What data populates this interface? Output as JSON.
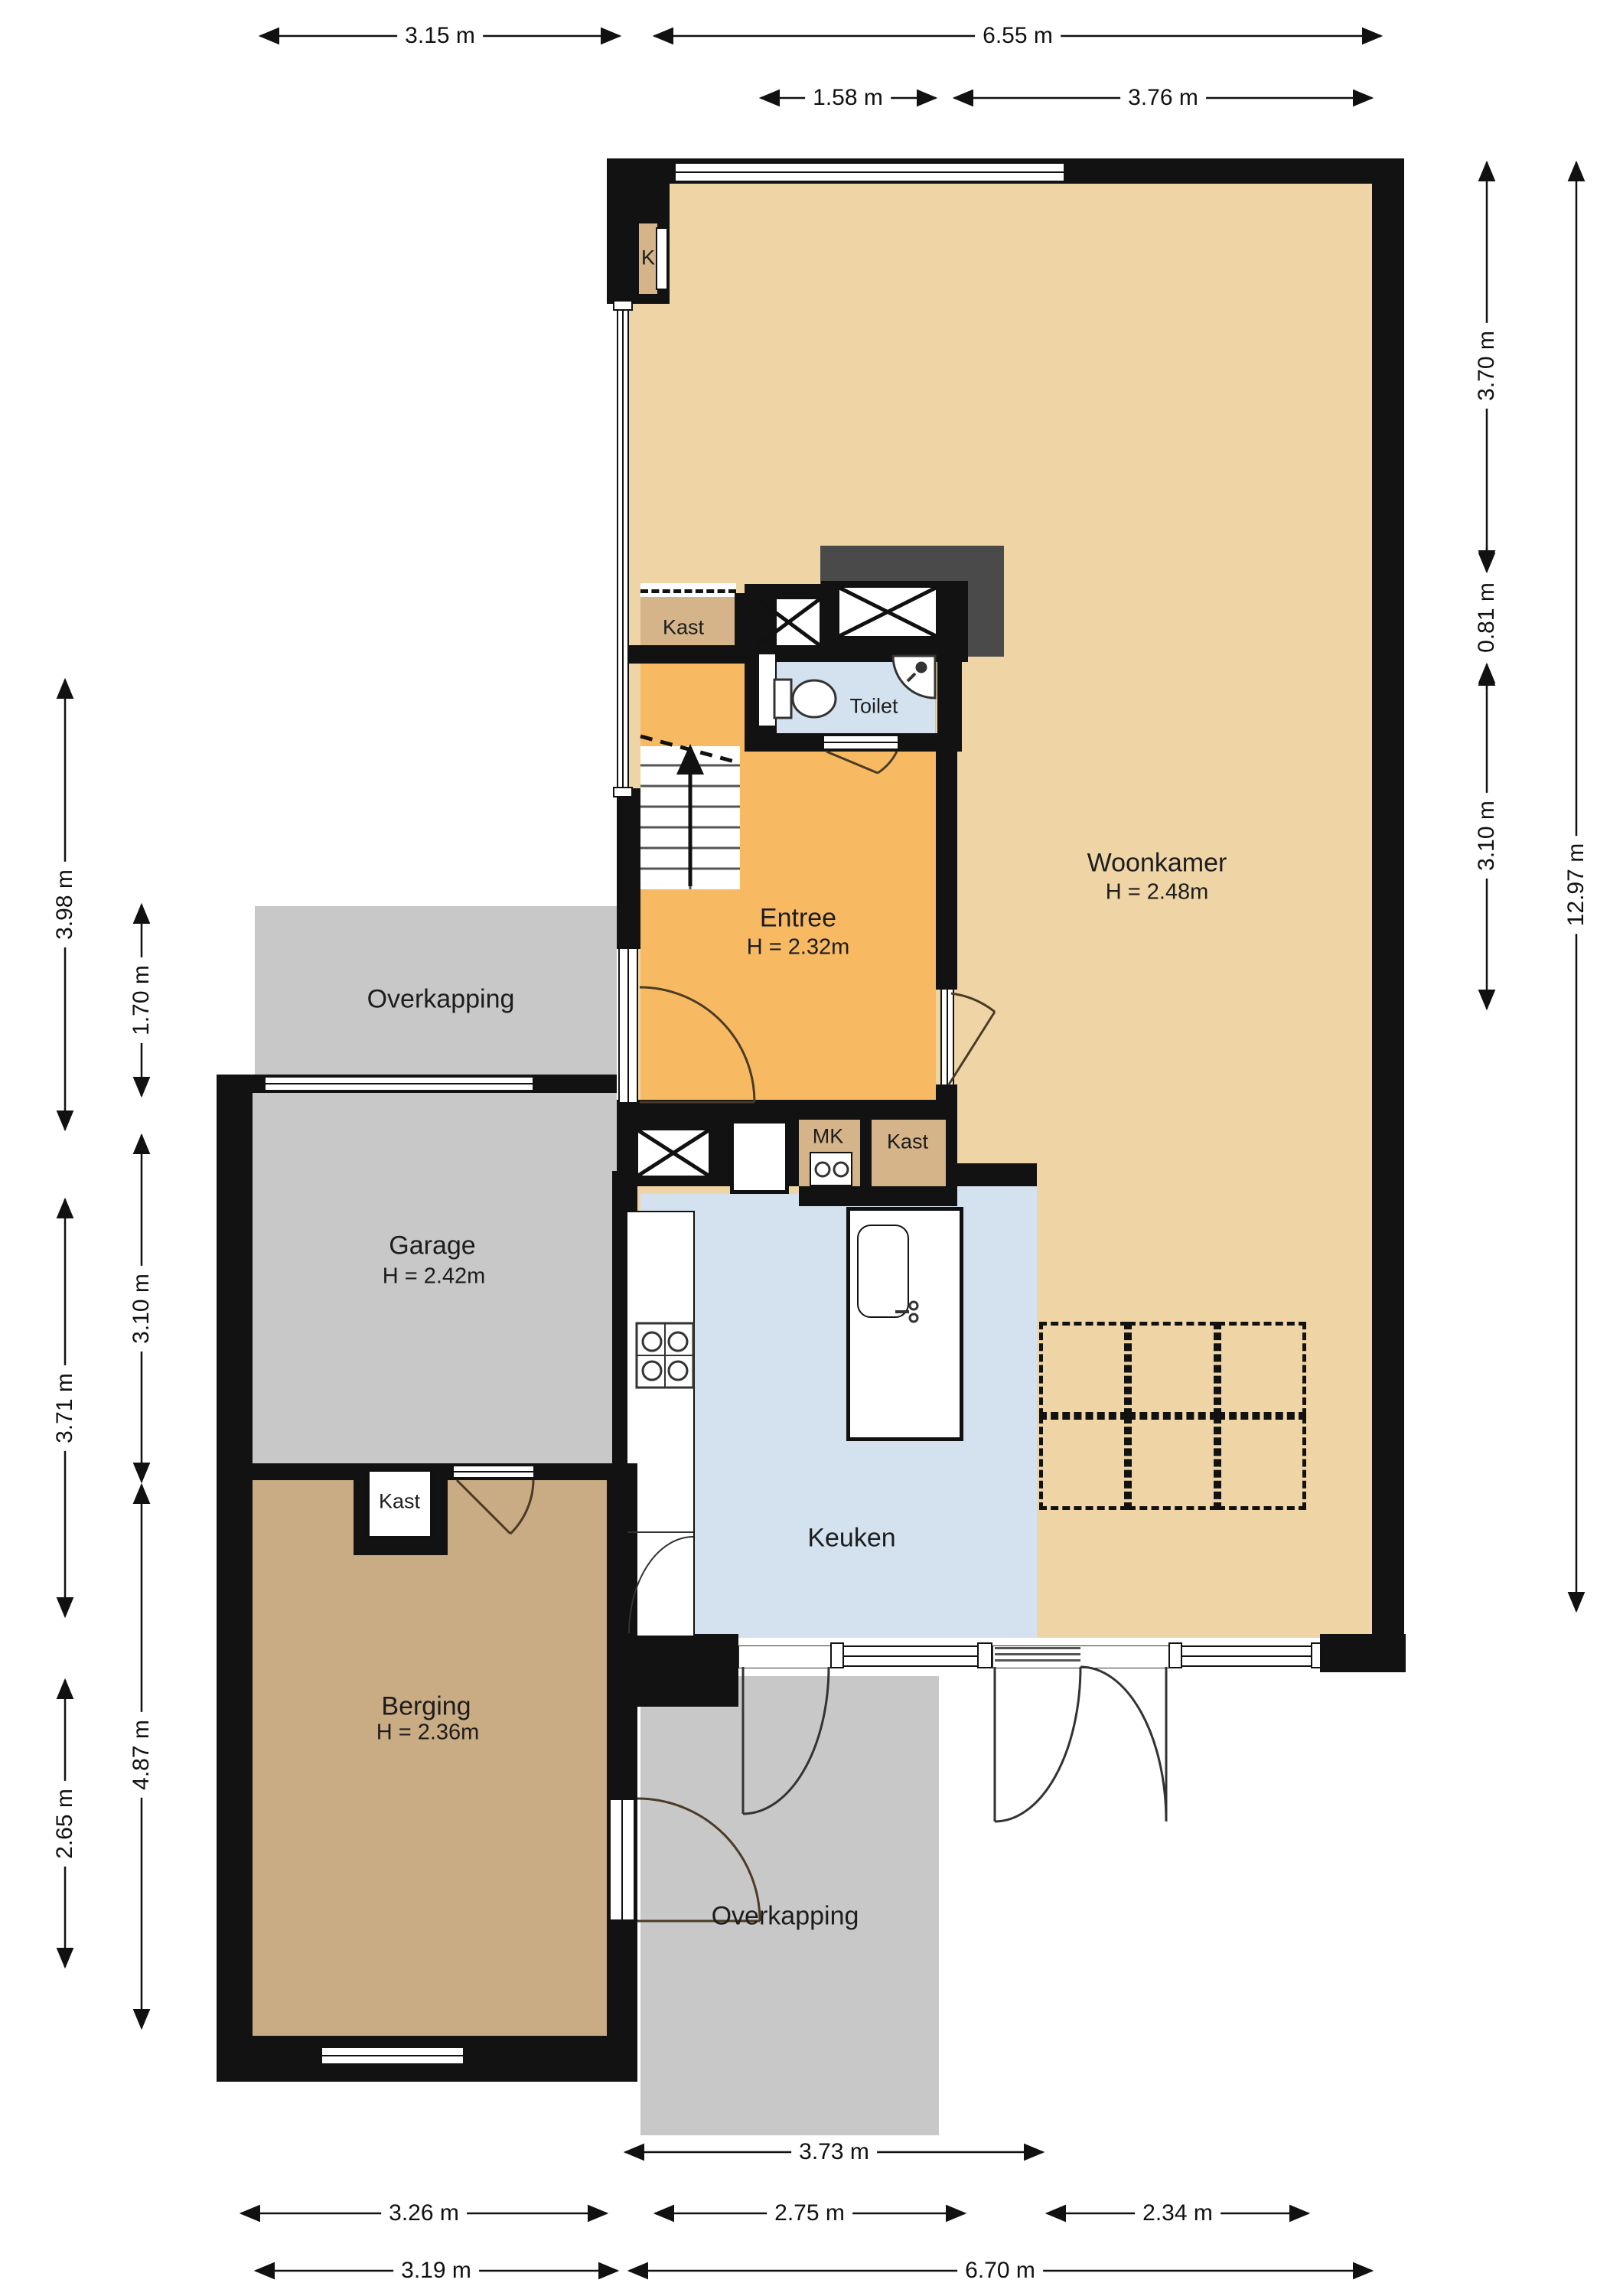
{
  "meta": {
    "type": "floorplan",
    "floor": "ground floor",
    "language": "nl"
  },
  "rooms": {
    "woonkamer": {
      "name": "Woonkamer",
      "height": "H = 2.48m"
    },
    "entree": {
      "name": "Entree",
      "height": "H = 2.32m"
    },
    "toilet": {
      "name": "Toilet"
    },
    "keuken": {
      "name": "Keuken"
    },
    "garage": {
      "name": "Garage",
      "height": "H = 2.42m"
    },
    "berging": {
      "name": "Berging",
      "height": "H = 2.36m"
    },
    "overkapping_boven": {
      "name": "Overkapping"
    },
    "overkapping_onder": {
      "name": "Overkapping"
    },
    "kast_hal": {
      "name": "Kast"
    },
    "kast_k": {
      "name": "K"
    },
    "mk": {
      "name": "MK"
    },
    "kast_entree": {
      "name": "Kast"
    },
    "kast_berging": {
      "name": "Kast"
    }
  },
  "dimensions": {
    "top_row1": [
      "3.15 m",
      "6.55 m"
    ],
    "top_row2": [
      "1.58 m",
      "3.76 m"
    ],
    "right_inner": [
      "3.70 m",
      "0.81 m",
      "3.10 m"
    ],
    "right_outer": [
      "12.97 m"
    ],
    "left_outer": [
      "3.98 m",
      "3.71 m",
      "2.65 m"
    ],
    "left_inner": [
      "1.70 m",
      "3.10 m",
      "4.87 m"
    ],
    "bottom_row1": [
      "3.73 m"
    ],
    "bottom_row2": [
      "3.26 m",
      "2.75 m",
      "2.34 m"
    ],
    "bottom_row3": [
      "3.19 m",
      "6.70 m"
    ]
  },
  "colors": {
    "wall": "#121212",
    "woonkamer_floor": "#efd5a6",
    "entree_floor": "#f7ba63",
    "kitchen_toilet_floor": "#d4e2ef",
    "garage_overkapping_floor": "#c8c8c8",
    "berging_floor": "#c9ab84",
    "kast_floor": "#d4b488",
    "chimney_block": "#4a4a4a"
  }
}
